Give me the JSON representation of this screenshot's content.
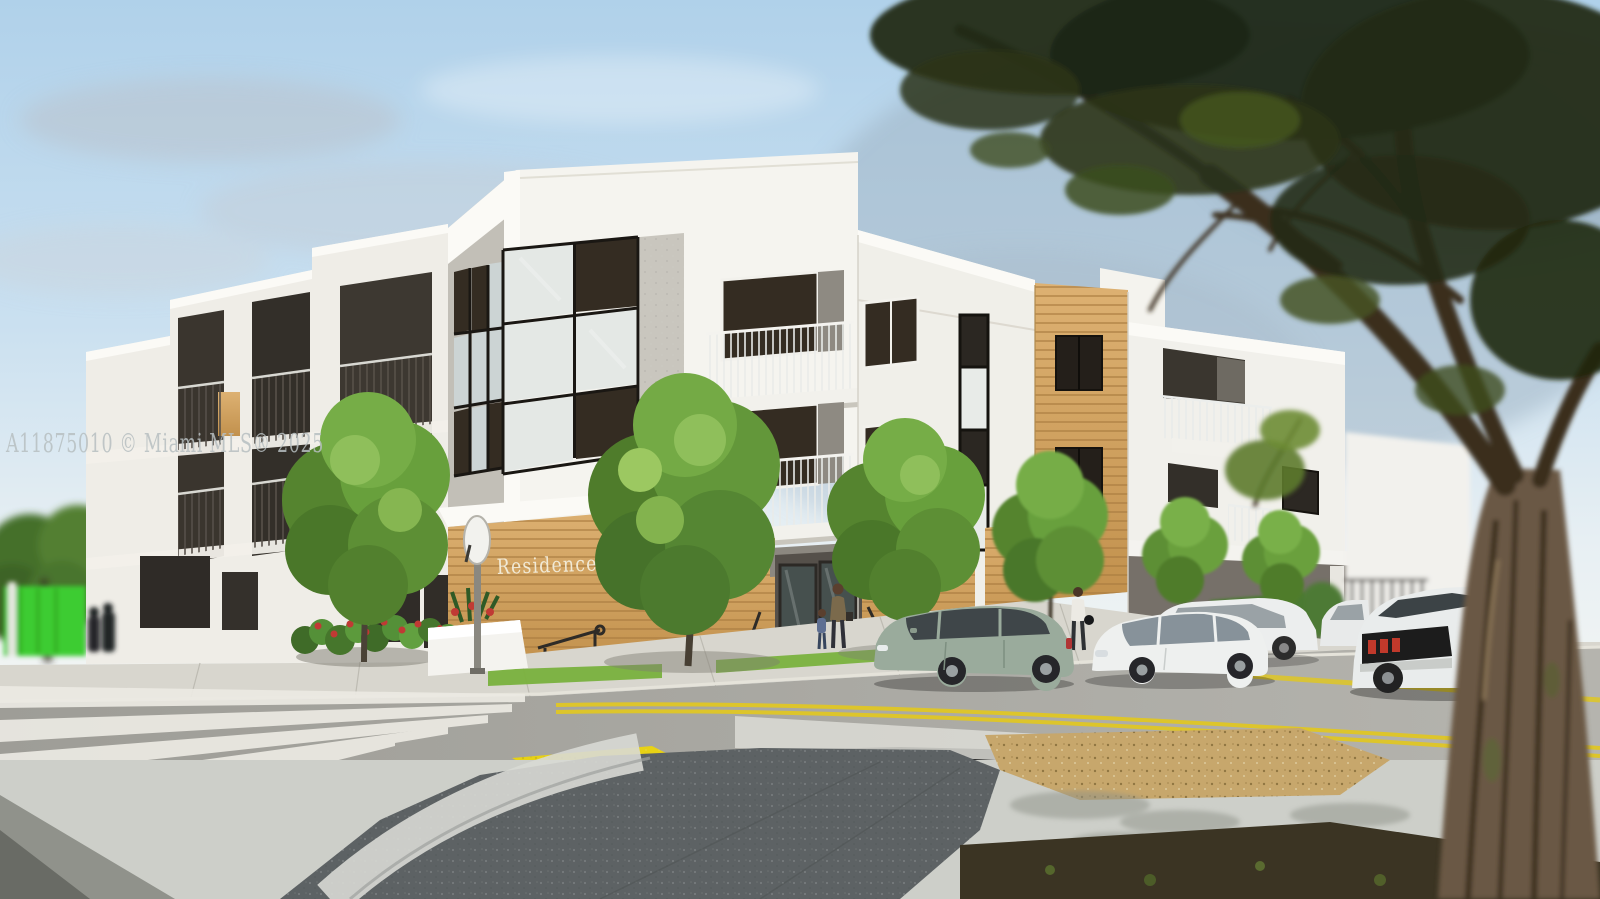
{
  "alt": "Architectural rendering of a modern three-story apartment building on a sunny street corner, with parked cars, street trees, crosswalk and a large blurred foreground tree on the right",
  "watermark": {
    "text": "A11875010 © Miami MLS® 2025"
  },
  "sign": {
    "text": "Residences 54"
  },
  "palette": {
    "sky_top": "#b3d2ea",
    "sky_horizon": "#f2f5f4",
    "cloud_gray": "#b9c2cc",
    "building_white": "#f5f4ef",
    "building_gray_face": "#c2bfb7",
    "stucco_speckle": "#c9c6be",
    "glass_dark": "#342c22",
    "glass_frosted": "#e4e8e5",
    "wood_panel": "#d5a766",
    "wood_slat_line": "#a97c3f",
    "foliage_green": "#7fae4a",
    "foliage_dark": "#4c7628",
    "fence_green": "#3ccc32",
    "asphalt": "#a5a49e",
    "sidewalk": "#d8d6ce",
    "crosswalk_white": "#eceae3",
    "road_marking_yellow": "#ddc52b",
    "tactile_paving_yellow": "#e8d214",
    "plaza_dark_concrete": "#5d6264",
    "gravel_tan": "#c7a76c",
    "mulch_dark": "#3b3423",
    "car_sage_green": "#9aab9c",
    "car_white": "#eef0ef",
    "taillight_red": "#b02020",
    "trunk_brown": "#6b5844"
  }
}
